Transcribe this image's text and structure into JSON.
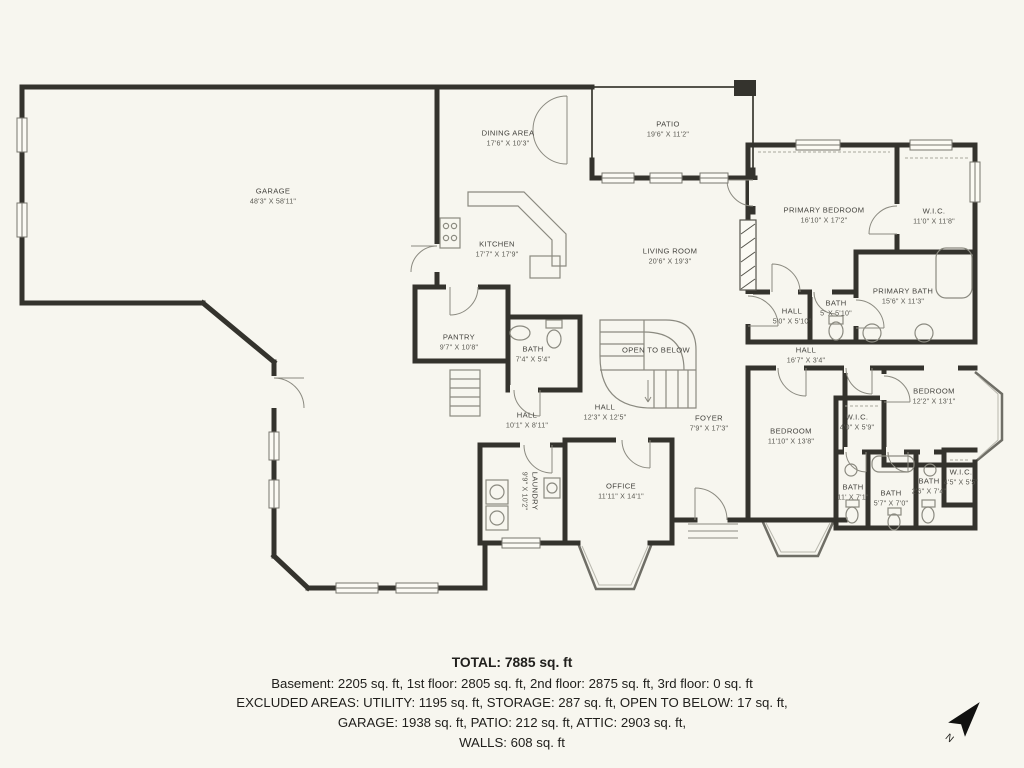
{
  "colors": {
    "background": "#f7f6ef",
    "wall": "#34332d",
    "thin_line": "#8b8a80",
    "label_text": "#45443f",
    "footer_text": "#21201d"
  },
  "rooms": [
    {
      "name": "GARAGE",
      "dims": "48'3\" X 58'11\""
    },
    {
      "name": "DINING AREA",
      "dims": "17'6\" X 10'3\""
    },
    {
      "name": "PATIO",
      "dims": "19'6\" X 11'2\""
    },
    {
      "name": "KITCHEN",
      "dims": "17'7\" X 17'9\""
    },
    {
      "name": "LIVING ROOM",
      "dims": "20'6\" X 19'3\""
    },
    {
      "name": "PRIMARY BEDROOM",
      "dims": "16'10\" X 17'2\""
    },
    {
      "name": "W.I.C.",
      "dims": "11'0\" X 11'8\""
    },
    {
      "name": "PRIMARY BATH",
      "dims": "15'6\" X 11'3\""
    },
    {
      "name": "BATH",
      "dims": "5' X 5'10\""
    },
    {
      "name": "HALL",
      "dims": "5'0\" X 5'10\""
    },
    {
      "name": "HALL",
      "dims": "16'7\" X 3'4\""
    },
    {
      "name": "PANTRY",
      "dims": "9'7\" X 10'8\""
    },
    {
      "name": "BATH",
      "dims": "7'4\" X 5'4\""
    },
    {
      "name": "OPEN TO BELOW",
      "dims": ""
    },
    {
      "name": "HALL",
      "dims": "12'3\" X 12'5\""
    },
    {
      "name": "HALL",
      "dims": "10'1\" X 8'11\""
    },
    {
      "name": "FOYER",
      "dims": "7'9\" X 17'3\""
    },
    {
      "name": "BEDROOM",
      "dims": "11'10\" X 13'8\""
    },
    {
      "name": "BEDROOM",
      "dims": "12'2\" X 13'1\""
    },
    {
      "name": "W.I.C.",
      "dims": "4'0\" X 5'9\""
    },
    {
      "name": "LAUNDRY",
      "dims": "9'9\" X 10'2\""
    },
    {
      "name": "OFFICE",
      "dims": "11'11\" X 14'1\""
    },
    {
      "name": "BATH",
      "dims": "11' X 7'1\""
    },
    {
      "name": "BATH",
      "dims": "5'7\" X 7'0\""
    },
    {
      "name": "BATH",
      "dims": "2'6\" X 7'4\""
    },
    {
      "name": "W.I.C.",
      "dims": "4'5\" X 5'5\""
    }
  ],
  "footer": {
    "total": "TOTAL: 7885 sq. ft",
    "line1": "Basement: 2205 sq. ft, 1st floor: 2805 sq. ft, 2nd floor: 2875 sq. ft, 3rd floor: 0 sq. ft",
    "line2": "EXCLUDED AREAS: UTILITY: 1195 sq. ft, STORAGE: 287 sq. ft, OPEN TO BELOW: 17 sq. ft,",
    "line3": "GARAGE: 1938 sq. ft, PATIO: 212 sq. ft, ATTIC: 2903 sq. ft,",
    "line4": "WALLS: 608 sq. ft"
  },
  "compass": {
    "label": "N"
  }
}
